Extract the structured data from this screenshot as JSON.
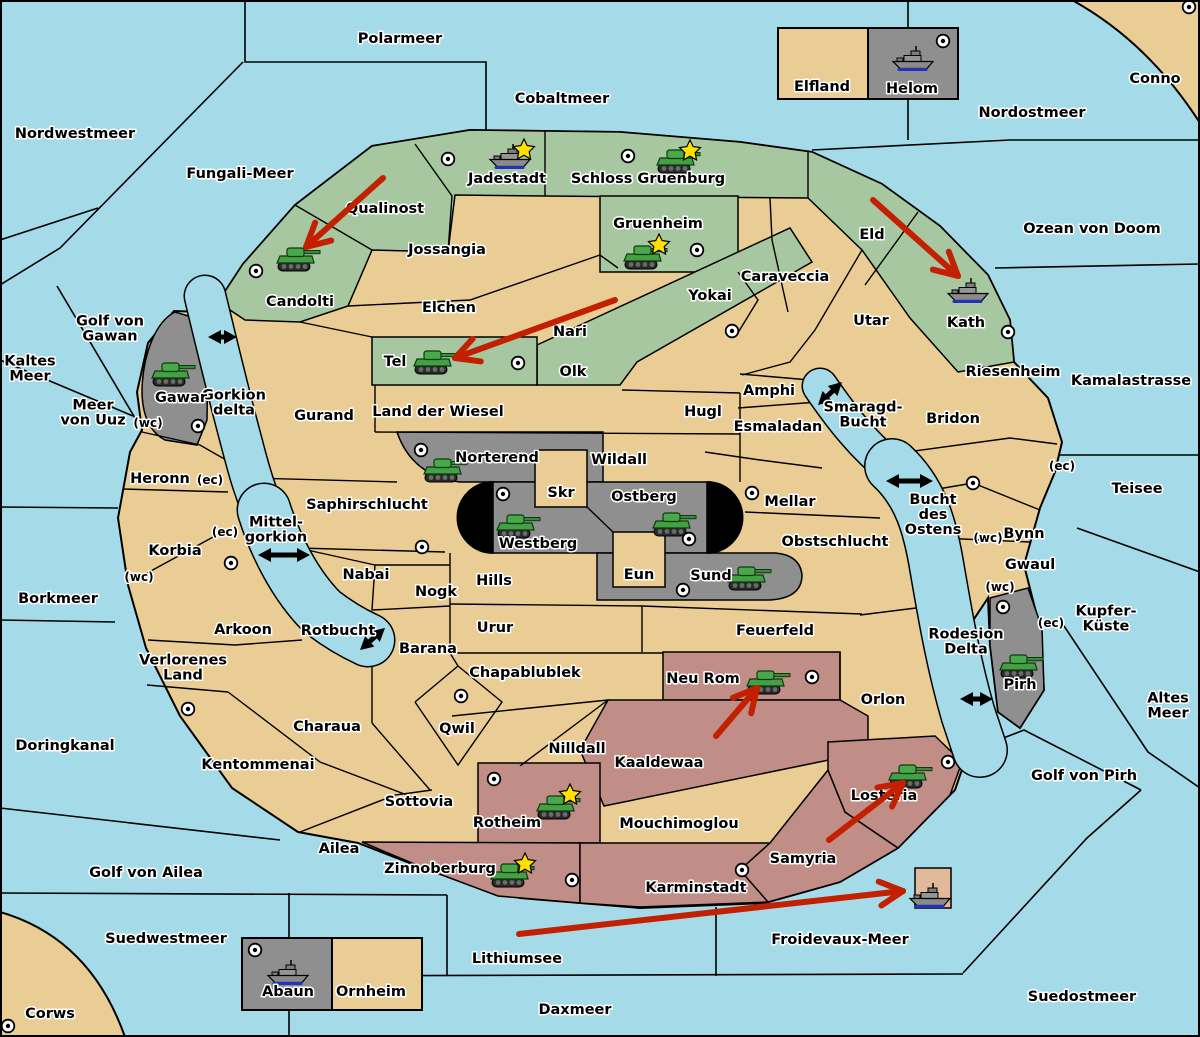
{
  "colors": {
    "sea": "#A5DBE8",
    "land": "#EACC95",
    "green": "#A7C7A0",
    "gray": "#8F8F8F",
    "red_region": "#C08D87",
    "arrow_red": "#C22000",
    "black": "#000000",
    "star": "#FFE000",
    "tank_green": "#44A044",
    "ship_gray": "#8A8A8A"
  },
  "labels": [
    {
      "text": "Polarmeer",
      "x": 400,
      "y": 38,
      "kind": "sea"
    },
    {
      "text": "Nordwestmeer",
      "x": 75,
      "y": 133,
      "kind": "sea"
    },
    {
      "text": "Fungali-Meer",
      "x": 240,
      "y": 173,
      "kind": "sea"
    },
    {
      "text": "Cobaltmeer",
      "x": 562,
      "y": 98,
      "kind": "sea"
    },
    {
      "text": "Nordostmeer",
      "x": 1032,
      "y": 112,
      "kind": "sea"
    },
    {
      "text": "Conno",
      "x": 1155,
      "y": 78,
      "kind": "land"
    },
    {
      "text": "Ozean von Doom",
      "x": 1092,
      "y": 228,
      "kind": "sea"
    },
    {
      "text": "Kamalastrasse",
      "x": 1131,
      "y": 380,
      "kind": "sea"
    },
    {
      "text": "Teisee",
      "x": 1137,
      "y": 488,
      "kind": "sea"
    },
    {
      "text": "Kaltes Meer",
      "lines": [
        "Kaltes",
        "Meer"
      ],
      "x": 30,
      "y": 368,
      "kind": "sea"
    },
    {
      "text": "Golf von Gawan",
      "lines": [
        "Golf von",
        "Gawan"
      ],
      "x": 110,
      "y": 328,
      "kind": "sea"
    },
    {
      "text": "Meer von Uuz",
      "lines": [
        "Meer",
        "von Uuz"
      ],
      "x": 93,
      "y": 412,
      "kind": "sea"
    },
    {
      "text": "Gorkion delta",
      "lines": [
        "Gorkion",
        "delta"
      ],
      "x": 234,
      "y": 402,
      "kind": "sea"
    },
    {
      "text": "Mittel-gorkion",
      "lines": [
        "Mittel-",
        "gorkion"
      ],
      "x": 276,
      "y": 529,
      "kind": "sea"
    },
    {
      "text": "Borkmeer",
      "x": 58,
      "y": 598,
      "kind": "sea"
    },
    {
      "text": "Rotbucht",
      "x": 338,
      "y": 630,
      "kind": "sea"
    },
    {
      "text": "Smaragd-Bucht",
      "lines": [
        "Smaragd-",
        "Bucht"
      ],
      "x": 863,
      "y": 414,
      "kind": "sea"
    },
    {
      "text": "Bucht des Ostens",
      "lines": [
        "Bucht",
        "des",
        "Ostens"
      ],
      "x": 933,
      "y": 514,
      "kind": "sea"
    },
    {
      "text": "Rodesion Delta",
      "lines": [
        "Rodesion",
        "Delta"
      ],
      "x": 966,
      "y": 641,
      "kind": "sea"
    },
    {
      "text": "Kupfer-Küste",
      "lines": [
        "Kupfer-",
        "Küste"
      ],
      "x": 1106,
      "y": 618,
      "kind": "sea"
    },
    {
      "text": "Altes Meer",
      "lines": [
        "Altes",
        "Meer"
      ],
      "x": 1168,
      "y": 705,
      "kind": "sea"
    },
    {
      "text": "Golf von Pirh",
      "x": 1084,
      "y": 775,
      "kind": "sea"
    },
    {
      "text": "Doringkanal",
      "x": 65,
      "y": 745,
      "kind": "sea"
    },
    {
      "text": "Golf von Ailea",
      "x": 146,
      "y": 872,
      "kind": "sea"
    },
    {
      "text": "Suedwestmeer",
      "x": 166,
      "y": 938,
      "kind": "sea"
    },
    {
      "text": "Corws",
      "x": 50,
      "y": 1013,
      "kind": "land"
    },
    {
      "text": "Lithiumsee",
      "x": 517,
      "y": 958,
      "kind": "sea"
    },
    {
      "text": "Froidevaux-Meer",
      "x": 840,
      "y": 939,
      "kind": "sea"
    },
    {
      "text": "Daxmeer",
      "x": 575,
      "y": 1009,
      "kind": "sea"
    },
    {
      "text": "Suedostmeer",
      "x": 1082,
      "y": 996,
      "kind": "sea"
    },
    {
      "text": "Qualinost",
      "x": 385,
      "y": 208,
      "kind": "land"
    },
    {
      "text": "Candolti",
      "x": 300,
      "y": 301,
      "kind": "land"
    },
    {
      "text": "Jadestadt",
      "x": 507,
      "y": 178,
      "kind": "land"
    },
    {
      "text": "Schloss Gruenburg",
      "x": 648,
      "y": 178,
      "kind": "land"
    },
    {
      "text": "Gruenheim",
      "x": 658,
      "y": 223,
      "kind": "land"
    },
    {
      "text": "Eld",
      "x": 872,
      "y": 234,
      "kind": "land"
    },
    {
      "text": "Kath",
      "x": 966,
      "y": 322,
      "kind": "land"
    },
    {
      "text": "Jossangia",
      "x": 447,
      "y": 249,
      "kind": "land"
    },
    {
      "text": "Elchen",
      "x": 449,
      "y": 307,
      "kind": "land"
    },
    {
      "text": "Nari",
      "x": 570,
      "y": 331,
      "kind": "land"
    },
    {
      "text": "Tel",
      "x": 395,
      "y": 361,
      "kind": "land"
    },
    {
      "text": "Olk",
      "x": 573,
      "y": 371,
      "kind": "land"
    },
    {
      "text": "Land der Wiesel",
      "x": 438,
      "y": 411,
      "kind": "land"
    },
    {
      "text": "Gurand",
      "x": 324,
      "y": 415,
      "kind": "land"
    },
    {
      "text": "Hugl",
      "x": 703,
      "y": 411,
      "kind": "land"
    },
    {
      "text": "Wildall",
      "x": 619,
      "y": 459,
      "kind": "land"
    },
    {
      "text": "Caraveccia",
      "x": 785,
      "y": 276,
      "kind": "land"
    },
    {
      "text": "Yokai",
      "x": 710,
      "y": 295,
      "kind": "land"
    },
    {
      "text": "Utar",
      "x": 871,
      "y": 320,
      "kind": "land"
    },
    {
      "text": "Amphi",
      "x": 769,
      "y": 390,
      "kind": "land"
    },
    {
      "text": "Esmaladan",
      "x": 778,
      "y": 426,
      "kind": "land"
    },
    {
      "text": "Riesenheim",
      "x": 1013,
      "y": 371,
      "kind": "land"
    },
    {
      "text": "Bridon",
      "x": 953,
      "y": 418,
      "kind": "land"
    },
    {
      "text": "Bynn",
      "x": 1024,
      "y": 533,
      "kind": "land"
    },
    {
      "text": "Gwaul",
      "x": 1030,
      "y": 564,
      "kind": "land"
    },
    {
      "text": "Mellar",
      "x": 790,
      "y": 501,
      "kind": "land"
    },
    {
      "text": "Obstschlucht",
      "x": 835,
      "y": 541,
      "kind": "land"
    },
    {
      "text": "Gawar",
      "x": 181,
      "y": 397,
      "kind": "land"
    },
    {
      "text": "Norterend",
      "x": 497,
      "y": 457,
      "kind": "land"
    },
    {
      "text": "Skr",
      "x": 561,
      "y": 492,
      "kind": "land"
    },
    {
      "text": "Ostberg",
      "x": 644,
      "y": 496,
      "kind": "land"
    },
    {
      "text": "Westberg",
      "x": 538,
      "y": 543,
      "kind": "land"
    },
    {
      "text": "Eun",
      "x": 639,
      "y": 574,
      "kind": "land"
    },
    {
      "text": "Sund",
      "x": 711,
      "y": 575,
      "kind": "land"
    },
    {
      "text": "Hills",
      "x": 494,
      "y": 580,
      "kind": "land"
    },
    {
      "text": "Nogk",
      "x": 436,
      "y": 591,
      "kind": "land"
    },
    {
      "text": "Urur",
      "x": 495,
      "y": 627,
      "kind": "land"
    },
    {
      "text": "Feuerfeld",
      "x": 775,
      "y": 630,
      "kind": "land"
    },
    {
      "text": "Nabai",
      "x": 366,
      "y": 574,
      "kind": "land"
    },
    {
      "text": "Saphirschlucht",
      "x": 367,
      "y": 504,
      "kind": "land"
    },
    {
      "text": "Heronn",
      "x": 160,
      "y": 478,
      "kind": "land"
    },
    {
      "text": "Korbia",
      "x": 175,
      "y": 550,
      "kind": "land"
    },
    {
      "text": "Arkoon",
      "x": 243,
      "y": 629,
      "kind": "land"
    },
    {
      "text": "Verlorenes Land",
      "lines": [
        "Verlorenes",
        "Land"
      ],
      "x": 183,
      "y": 667,
      "kind": "land"
    },
    {
      "text": "Charaua",
      "x": 327,
      "y": 726,
      "kind": "land"
    },
    {
      "text": "Kentommenai",
      "x": 258,
      "y": 764,
      "kind": "land"
    },
    {
      "text": "Barana",
      "x": 428,
      "y": 648,
      "kind": "land"
    },
    {
      "text": "Qwil",
      "x": 457,
      "y": 728,
      "kind": "land"
    },
    {
      "text": "Chapablublek",
      "x": 525,
      "y": 672,
      "kind": "land"
    },
    {
      "text": "Nilldall",
      "x": 577,
      "y": 748,
      "kind": "land"
    },
    {
      "text": "Sottovia",
      "x": 419,
      "y": 801,
      "kind": "land"
    },
    {
      "text": "Ailea",
      "x": 339,
      "y": 848,
      "kind": "land"
    },
    {
      "text": "Mouchimoglou",
      "x": 679,
      "y": 823,
      "kind": "land"
    },
    {
      "text": "Orlon",
      "x": 883,
      "y": 699,
      "kind": "land"
    },
    {
      "text": "Neu Rom",
      "x": 703,
      "y": 678,
      "kind": "land"
    },
    {
      "text": "Kaaldewaa",
      "x": 659,
      "y": 762,
      "kind": "land"
    },
    {
      "text": "Rotheim",
      "x": 507,
      "y": 822,
      "kind": "land"
    },
    {
      "text": "Zinnoberburg",
      "x": 440,
      "y": 868,
      "kind": "land"
    },
    {
      "text": "Karminstadt",
      "x": 696,
      "y": 887,
      "kind": "land"
    },
    {
      "text": "Samyria",
      "x": 803,
      "y": 858,
      "kind": "land"
    },
    {
      "text": "Losteria",
      "x": 884,
      "y": 795,
      "kind": "land"
    },
    {
      "text": "Pirh",
      "x": 1020,
      "y": 684,
      "kind": "land"
    },
    {
      "text": "Elfland",
      "x": 822,
      "y": 86,
      "kind": "land"
    },
    {
      "text": "Helom",
      "x": 912,
      "y": 88,
      "kind": "land"
    },
    {
      "text": "Abaun",
      "x": 288,
      "y": 991,
      "kind": "land"
    },
    {
      "text": "Ornheim",
      "x": 371,
      "y": 991,
      "kind": "land"
    },
    {
      "text": "(wc)",
      "x": 148,
      "y": 422,
      "kind": "note",
      "small": true
    },
    {
      "text": "(wc)",
      "x": 139,
      "y": 576,
      "kind": "note",
      "small": true
    },
    {
      "text": "(ec)",
      "x": 225,
      "y": 531,
      "kind": "note",
      "small": true
    },
    {
      "text": "(ec)",
      "x": 210,
      "y": 479,
      "kind": "note",
      "small": true
    },
    {
      "text": "(wc)",
      "x": 988,
      "y": 537,
      "kind": "note",
      "small": true
    },
    {
      "text": "(wc)",
      "x": 1000,
      "y": 586,
      "kind": "note",
      "small": true
    },
    {
      "text": "(ec)",
      "x": 1051,
      "y": 622,
      "kind": "note",
      "small": true
    },
    {
      "text": "(ec)",
      "x": 1062,
      "y": 465,
      "kind": "note",
      "small": true
    }
  ],
  "icons": {
    "tanks": [
      {
        "x": 298,
        "y": 259
      },
      {
        "x": 678,
        "y": 161
      },
      {
        "x": 645,
        "y": 257
      },
      {
        "x": 435,
        "y": 362
      },
      {
        "x": 445,
        "y": 470
      },
      {
        "x": 518,
        "y": 526
      },
      {
        "x": 674,
        "y": 524
      },
      {
        "x": 749,
        "y": 578
      },
      {
        "x": 173,
        "y": 374
      },
      {
        "x": 1021,
        "y": 666
      },
      {
        "x": 768,
        "y": 682
      },
      {
        "x": 558,
        "y": 807
      },
      {
        "x": 512,
        "y": 875
      },
      {
        "x": 910,
        "y": 776
      }
    ],
    "ships": [
      {
        "x": 510,
        "y": 157
      },
      {
        "x": 913,
        "y": 59
      },
      {
        "x": 968,
        "y": 291
      },
      {
        "x": 288,
        "y": 973
      },
      {
        "x": 930,
        "y": 896
      }
    ],
    "stars": [
      {
        "x": 524,
        "y": 150
      },
      {
        "x": 690,
        "y": 151
      },
      {
        "x": 659,
        "y": 245
      },
      {
        "x": 570,
        "y": 795
      },
      {
        "x": 525,
        "y": 864
      }
    ],
    "bullseyes": [
      {
        "x": 448,
        "y": 159
      },
      {
        "x": 628,
        "y": 156
      },
      {
        "x": 256,
        "y": 271
      },
      {
        "x": 697,
        "y": 250
      },
      {
        "x": 518,
        "y": 363
      },
      {
        "x": 198,
        "y": 426
      },
      {
        "x": 421,
        "y": 450
      },
      {
        "x": 503,
        "y": 494
      },
      {
        "x": 689,
        "y": 539
      },
      {
        "x": 683,
        "y": 590
      },
      {
        "x": 752,
        "y": 493
      },
      {
        "x": 732,
        "y": 331
      },
      {
        "x": 973,
        "y": 483
      },
      {
        "x": 422,
        "y": 547
      },
      {
        "x": 231,
        "y": 563
      },
      {
        "x": 188,
        "y": 709
      },
      {
        "x": 461,
        "y": 696
      },
      {
        "x": 494,
        "y": 779
      },
      {
        "x": 572,
        "y": 880
      },
      {
        "x": 742,
        "y": 870
      },
      {
        "x": 812,
        "y": 677
      },
      {
        "x": 948,
        "y": 762
      },
      {
        "x": 1003,
        "y": 607
      },
      {
        "x": 1008,
        "y": 332
      },
      {
        "x": 255,
        "y": 950
      },
      {
        "x": 8,
        "y": 1026
      },
      {
        "x": 1189,
        "y": 7
      },
      {
        "x": 943,
        "y": 41
      }
    ]
  },
  "red_arrows": [
    {
      "x1": 383,
      "y1": 178,
      "x2": 306,
      "y2": 247
    },
    {
      "x1": 615,
      "y1": 300,
      "x2": 455,
      "y2": 358
    },
    {
      "x1": 873,
      "y1": 200,
      "x2": 958,
      "y2": 276
    },
    {
      "x1": 716,
      "y1": 736,
      "x2": 757,
      "y2": 688
    },
    {
      "x1": 829,
      "y1": 840,
      "x2": 903,
      "y2": 783
    },
    {
      "x1": 519,
      "y1": 934,
      "x2": 903,
      "y2": 891
    }
  ],
  "black_arrows": [
    {
      "x1": 208,
      "y1": 337,
      "x2": 237,
      "y2": 337
    },
    {
      "x1": 258,
      "y1": 555,
      "x2": 310,
      "y2": 555
    },
    {
      "x1": 360,
      "y1": 650,
      "x2": 385,
      "y2": 628
    },
    {
      "x1": 818,
      "y1": 405,
      "x2": 842,
      "y2": 382
    },
    {
      "x1": 886,
      "y1": 481,
      "x2": 933,
      "y2": 481
    },
    {
      "x1": 960,
      "y1": 699,
      "x2": 993,
      "y2": 699
    }
  ]
}
